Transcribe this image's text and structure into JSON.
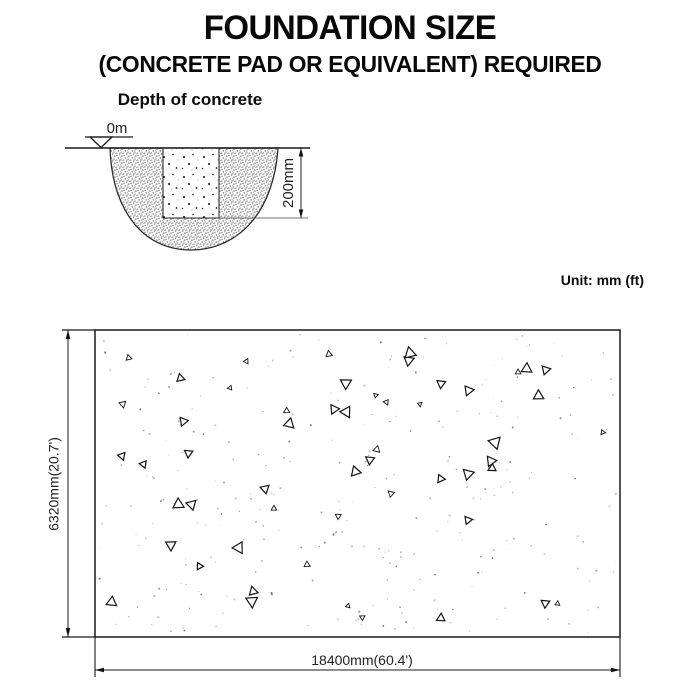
{
  "header": {
    "title": "FOUNDATION SIZE",
    "subtitle": "(CONCRETE PAD OR EQUIVALENT) REQUIRED"
  },
  "depth_figure": {
    "title": "Depth of concrete",
    "ground_level_label": "0m",
    "depth_dimension_label": "200mm"
  },
  "unit_note": "Unit: mm (ft)",
  "plan_figure": {
    "height_dimension_label": "6320mm(20.7')",
    "width_dimension_label": "18400mm(60.4')"
  },
  "colors": {
    "ink": "#1a1a1a",
    "background": "#ffffff",
    "gravel_dot": "#8f8f8f"
  }
}
